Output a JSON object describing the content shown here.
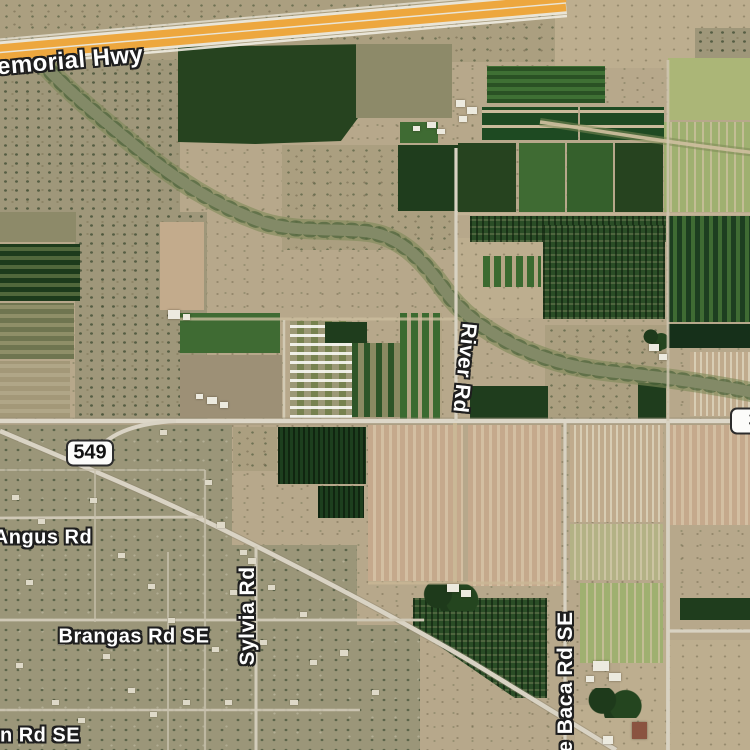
{
  "map": {
    "type": "satellite-imagery",
    "colors": {
      "base_terrain": "#b7a88b",
      "highway_orange": "#eda73e",
      "label_text": "#ffffff",
      "label_outline": "#1e1e1e",
      "shield_background": "#fcfcfa",
      "shield_border": "#2c2c2c",
      "shield_text": "#111111"
    },
    "road_labels": [
      {
        "name": "memorial-hwy",
        "text": "Memorial Hwy",
        "x": 60,
        "y": 62,
        "rotate": -5,
        "size": 24
      },
      {
        "name": "river-rd",
        "text": "River Rd",
        "x": 464,
        "y": 368,
        "rotate": 96,
        "size": 21
      },
      {
        "name": "angus-rd",
        "text": "Angus Rd",
        "x": 43,
        "y": 538,
        "rotate": 0,
        "size": 20
      },
      {
        "name": "sylvia-rd",
        "text": "Sylvia Rd",
        "x": 248,
        "y": 616,
        "rotate": -90,
        "size": 21
      },
      {
        "name": "brangas-rd-se",
        "text": "Brangas Rd SE",
        "x": 134,
        "y": 637,
        "rotate": 0,
        "size": 20
      },
      {
        "name": "in-rd-se",
        "text": "in Rd SE",
        "x": 37,
        "y": 736,
        "rotate": 0,
        "size": 20
      },
      {
        "name": "e-baca-rd-se",
        "text": "e Baca Rd SE",
        "x": 566,
        "y": 682,
        "rotate": -90,
        "size": 21
      }
    ],
    "route_shields": [
      {
        "name": "route-shield-549",
        "text": "549",
        "x": 90,
        "y": 453
      },
      {
        "name": "route-shield-3-partial",
        "text": "3",
        "x": 754,
        "y": 421
      }
    ]
  },
  "terrain": {
    "patches": [
      [
        0,
        0,
        562,
        62,
        "scrub2"
      ],
      [
        555,
        0,
        195,
        68,
        "scrub1"
      ],
      [
        695,
        28,
        55,
        32,
        "scrub3"
      ],
      [
        0,
        60,
        180,
        152,
        "scrub3"
      ],
      [
        75,
        212,
        132,
        208,
        "scrub3"
      ],
      [
        282,
        145,
        175,
        105,
        "scrub2"
      ],
      [
        455,
        238,
        95,
        80,
        "scrub1"
      ],
      [
        545,
        325,
        122,
        98,
        "scrub2"
      ],
      [
        0,
        425,
        232,
        325,
        "resid"
      ],
      [
        232,
        545,
        125,
        205,
        "resid"
      ],
      [
        330,
        625,
        90,
        125,
        "resid"
      ],
      [
        620,
        640,
        130,
        112,
        "scrub1"
      ],
      [
        575,
        705,
        95,
        45,
        "scrub1"
      ],
      [
        178,
        44,
        194,
        100,
        "gDark",
        "clipA"
      ],
      [
        356,
        44,
        96,
        74,
        "fallow"
      ],
      [
        400,
        122,
        38,
        21,
        "gMed"
      ],
      [
        398,
        145,
        60,
        66,
        "gDark2"
      ],
      [
        487,
        66,
        118,
        37,
        "gRows"
      ],
      [
        482,
        107,
        96,
        33,
        "gBand"
      ],
      [
        580,
        107,
        84,
        33,
        "gBand"
      ],
      [
        458,
        143,
        58,
        69,
        "gDark"
      ],
      [
        519,
        143,
        46,
        69,
        "gMed"
      ],
      [
        567,
        143,
        46,
        69,
        "gMed2"
      ],
      [
        615,
        143,
        48,
        69,
        "gDark"
      ],
      [
        668,
        58,
        82,
        62,
        "gPale"
      ],
      [
        664,
        122,
        86,
        90,
        "gPaleRows"
      ],
      [
        470,
        216,
        196,
        26,
        "orchard"
      ],
      [
        543,
        225,
        122,
        94,
        "orchard"
      ],
      [
        483,
        256,
        58,
        31,
        "gMedRows"
      ],
      [
        668,
        216,
        82,
        106,
        "gDarkRowsV"
      ],
      [
        668,
        324,
        82,
        24,
        "gDarkest"
      ],
      [
        690,
        352,
        60,
        64,
        "paleRowsV"
      ],
      [
        0,
        212,
        76,
        30,
        "fallow"
      ],
      [
        0,
        244,
        80,
        57,
        "gDarkRows"
      ],
      [
        0,
        303,
        74,
        56,
        "oliveRows"
      ],
      [
        0,
        361,
        70,
        57,
        "scrubRows"
      ],
      [
        160,
        222,
        44,
        88,
        "tanField"
      ],
      [
        180,
        313,
        100,
        40,
        "gMed"
      ],
      [
        180,
        355,
        102,
        63,
        "fallow2"
      ],
      [
        290,
        321,
        62,
        97,
        "thPark"
      ],
      [
        325,
        322,
        42,
        21,
        "gDark2"
      ],
      [
        352,
        343,
        48,
        74,
        "gMixRows"
      ],
      [
        400,
        313,
        42,
        110,
        "gMedRows"
      ],
      [
        470,
        386,
        78,
        35,
        "gDark2"
      ],
      [
        638,
        383,
        28,
        38,
        "gDark2"
      ],
      [
        643,
        327,
        26,
        24,
        "trees"
      ],
      [
        233,
        427,
        44,
        44,
        "scrub2"
      ],
      [
        278,
        427,
        88,
        57,
        "orchardV"
      ],
      [
        318,
        486,
        46,
        32,
        "orchardV"
      ],
      [
        368,
        425,
        95,
        156,
        "pinkRows"
      ],
      [
        468,
        425,
        93,
        161,
        "pinkRows"
      ],
      [
        570,
        425,
        93,
        97,
        "paleRowsV"
      ],
      [
        570,
        524,
        93,
        56,
        "paleRowsV2"
      ],
      [
        580,
        583,
        83,
        80,
        "gPaleRows"
      ],
      [
        668,
        425,
        82,
        100,
        "pinkRows"
      ],
      [
        413,
        598,
        134,
        100,
        "orchard",
        "clipB"
      ],
      [
        420,
        583,
        60,
        28,
        "trees"
      ],
      [
        680,
        598,
        70,
        22,
        "gDark2"
      ],
      [
        585,
        688,
        58,
        30,
        "trees"
      ]
    ]
  },
  "wash": [
    {
      "name": "wash-vegetation",
      "d": "M 42,62 C 62,86 96,114 136,147 C 176,180 216,206 262,222 C 296,233 336,228 368,232 C 398,236 420,256 443,288 C 462,314 482,328 510,343 C 540,358 572,368 612,372 C 652,376 702,382 756,393",
      "w": 20,
      "c": "#7e8a58",
      "o": 0.6
    },
    {
      "name": "wash-sand",
      "d": "M 42,62 C 62,86 96,114 136,147 C 176,180 216,206 262,222 C 296,233 336,228 368,232 C 398,236 420,256 443,288 C 462,314 482,328 510,343 C 540,358 572,368 612,372 C 652,376 702,382 756,393",
      "w": 11,
      "c": "#d4c5a5",
      "o": 1
    },
    {
      "name": "wash-trees",
      "d": "M 42,62 C 62,86 96,114 136,147 C 176,180 216,206 262,222 C 296,233 336,228 368,232 C 398,236 420,256 443,288 C 462,314 482,328 510,343 C 540,358 572,368 612,372 C 652,376 702,382 756,393",
      "w": 16,
      "c": "#31502a",
      "o": 0.5,
      "dash": "2 12"
    },
    {
      "name": "wash-upper-vegetation",
      "d": "M 540,122 C 596,130 648,140 756,153",
      "w": 8,
      "c": "#7e8a58",
      "o": 0.55
    },
    {
      "name": "wash-upper-sand",
      "d": "M 540,122 C 596,130 648,140 756,153",
      "w": 3.5,
      "c": "#cfc0a0",
      "o": 0.9
    }
  ],
  "roads": [
    {
      "name": "memorial-hwy-roadbed",
      "d": "M -6,53 L 566,3",
      "w": 22,
      "c": "#e9e5d8"
    },
    {
      "name": "memorial-hwy-lanes-north",
      "d": "M -6,48.5 L 566,-1.5",
      "w": 7.5,
      "c": "#eda73e"
    },
    {
      "name": "memorial-hwy-lanes-south",
      "d": "M -6,57.5 L 566,7.5",
      "w": 7.5,
      "c": "#eda73e"
    },
    {
      "name": "frontage-road-south",
      "d": "M -4,66 L 567,16",
      "w": 2.5,
      "c": "#efece1",
      "o": 0.9
    },
    {
      "name": "frontage-road-north",
      "d": "M -7,40 L 564,-10",
      "w": 2,
      "c": "#efece1",
      "o": 0.7
    },
    {
      "name": "boundary-north-fields",
      "d": "M 455,214 L 750,214",
      "w": 2.5,
      "c": "#cbbd9e",
      "o": 0.6
    },
    {
      "name": "boundary-trailer-north",
      "d": "M 180,319 L 455,319",
      "w": 3,
      "c": "#cbbd9e",
      "o": 0.8
    },
    {
      "name": "grid-road-v283",
      "d": "M 284,320 L 284,420",
      "w": 2.5,
      "c": "#d5cdb8",
      "o": 0.9
    },
    {
      "name": "main-road-casing",
      "d": "M 0,421 L 750,421",
      "w": 7,
      "c": "#8f866e",
      "o": 0.5
    },
    {
      "name": "main-road",
      "d": "M 0,421 L 750,421",
      "w": 4.5,
      "c": "#ddd7c8"
    },
    {
      "name": "route-549-casing",
      "d": "M 0,431 C 80,465 160,498 240,538 C 320,578 400,620 470,661 C 520,691 570,722 616,750",
      "w": 6.5,
      "c": "#8f866e",
      "o": 0.45
    },
    {
      "name": "route-549",
      "d": "M 0,431 C 80,465 160,498 240,538 C 320,578 400,620 470,661 C 520,691 570,722 616,750",
      "w": 4.5,
      "c": "#d9d3c4"
    },
    {
      "name": "route-549-connector",
      "d": "M 176,421 C 138,423 110,432 96,452",
      "w": 4,
      "c": "#d9d3c4"
    },
    {
      "name": "river-rd-road",
      "d": "M 456,148 L 456,421",
      "w": 3.2,
      "c": "#d8d2c2"
    },
    {
      "name": "de-baca-rd-road",
      "d": "M 565,423 L 565,750",
      "w": 3.2,
      "c": "#d8d2c2"
    },
    {
      "name": "east-road-north",
      "d": "M 668,60 L 668,421",
      "w": 2.8,
      "c": "#cfc6b0",
      "o": 0.85
    },
    {
      "name": "east-road-south",
      "d": "M 668,421 L 668,750",
      "w": 3.8,
      "c": "#d8d2c2"
    },
    {
      "name": "east-road-spur",
      "d": "M 668,631 L 750,631",
      "w": 3.2,
      "c": "#d8d2c2"
    },
    {
      "name": "angus-rd-road",
      "d": "M 0,518 L 203,517",
      "w": 2.8,
      "c": "#cfc8b6"
    },
    {
      "name": "brangas-rd-road",
      "d": "M 0,620 L 424,620",
      "w": 2.8,
      "c": "#cfc8b6"
    },
    {
      "name": "south-rd-road",
      "d": "M 0,710 L 360,710",
      "w": 2.5,
      "c": "#cfc8b6",
      "o": 0.9
    },
    {
      "name": "sylvia-rd-road",
      "d": "M 256,546 L 256,750",
      "w": 3,
      "c": "#d2ccba"
    },
    {
      "name": "grid-road-v168",
      "d": "M 168,552 L 168,750",
      "w": 2,
      "c": "#c7c0ac",
      "o": 0.8
    },
    {
      "name": "grid-road-v205",
      "d": "M 205,470 L 205,750",
      "w": 2.2,
      "c": "#c7c0ac",
      "o": 0.8
    },
    {
      "name": "grid-road-v95",
      "d": "M 95,470 L 95,622",
      "w": 2,
      "c": "#c7c0ac",
      "o": 0.7
    },
    {
      "name": "grid-road-h470",
      "d": "M 0,470 L 205,470",
      "w": 2,
      "c": "#c7c0ac",
      "o": 0.7
    },
    {
      "name": "farm-track",
      "d": "M 455,423 L 455,583",
      "w": 4,
      "c": "#c9b795",
      "o": 0.9
    },
    {
      "name": "boundary-h583",
      "d": "M 368,583 L 560,583",
      "w": 3,
      "c": "#c9b795",
      "o": 0.8
    }
  ],
  "buildings": [
    [
      456,
      100,
      9,
      7,
      "bld"
    ],
    [
      467,
      107,
      10,
      7,
      "bld"
    ],
    [
      459,
      116,
      8,
      6,
      "bld"
    ],
    [
      427,
      122,
      9,
      6,
      "bld"
    ],
    [
      437,
      129,
      8,
      5,
      "bld"
    ],
    [
      413,
      126,
      7,
      5,
      "bld"
    ],
    [
      168,
      310,
      12,
      9,
      "bld"
    ],
    [
      183,
      314,
      7,
      6,
      "bld"
    ],
    [
      207,
      397,
      10,
      7,
      "bld"
    ],
    [
      220,
      402,
      8,
      6,
      "bld"
    ],
    [
      196,
      394,
      7,
      5,
      "bld"
    ],
    [
      649,
      344,
      10,
      7,
      "bld"
    ],
    [
      659,
      354,
      8,
      6,
      "bld"
    ],
    [
      447,
      584,
      12,
      8,
      "bld"
    ],
    [
      461,
      590,
      10,
      7,
      "bld"
    ],
    [
      593,
      661,
      16,
      10,
      "bld"
    ],
    [
      609,
      673,
      12,
      8,
      "bld"
    ],
    [
      586,
      676,
      8,
      6,
      "bld"
    ],
    [
      632,
      722,
      15,
      17,
      "bldR"
    ],
    [
      603,
      736,
      10,
      8,
      "bld"
    ],
    [
      248,
      558,
      8,
      6,
      "bldS"
    ],
    [
      240,
      550,
      7,
      5,
      "bldS"
    ],
    [
      217,
      522,
      8,
      6,
      "bldS"
    ],
    [
      12,
      495,
      7,
      5,
      "bldS"
    ],
    [
      38,
      519,
      7,
      5,
      "bldS"
    ],
    [
      90,
      498,
      7,
      5,
      "bldS"
    ],
    [
      118,
      553,
      7,
      5,
      "bldS"
    ],
    [
      26,
      580,
      7,
      5,
      "bldS"
    ],
    [
      148,
      584,
      7,
      5,
      "bldS"
    ],
    [
      58,
      640,
      7,
      5,
      "bldS"
    ],
    [
      16,
      663,
      7,
      5,
      "bldS"
    ],
    [
      103,
      654,
      7,
      5,
      "bldS"
    ],
    [
      168,
      618,
      7,
      5,
      "bldS"
    ],
    [
      128,
      688,
      7,
      5,
      "bldS"
    ],
    [
      52,
      700,
      7,
      5,
      "bldS"
    ],
    [
      183,
      700,
      7,
      5,
      "bldS"
    ],
    [
      212,
      647,
      7,
      5,
      "bldS"
    ],
    [
      78,
      718,
      7,
      5,
      "bldS"
    ],
    [
      150,
      712,
      7,
      5,
      "bldS"
    ],
    [
      230,
      590,
      7,
      5,
      "bldS"
    ],
    [
      205,
      480,
      7,
      5,
      "bldS"
    ],
    [
      95,
      445,
      8,
      6,
      "bldS"
    ],
    [
      160,
      430,
      7,
      5,
      "bldS"
    ],
    [
      268,
      585,
      7,
      5,
      "bldS"
    ],
    [
      300,
      612,
      7,
      5,
      "bldS"
    ],
    [
      340,
      650,
      8,
      6,
      "bldS"
    ],
    [
      310,
      660,
      7,
      5,
      "bldS"
    ],
    [
      372,
      690,
      7,
      5,
      "bldS"
    ],
    [
      260,
      640,
      7,
      5,
      "bldS"
    ],
    [
      290,
      700,
      8,
      5,
      "bldS"
    ],
    [
      225,
      700,
      7,
      5,
      "bldS"
    ]
  ]
}
